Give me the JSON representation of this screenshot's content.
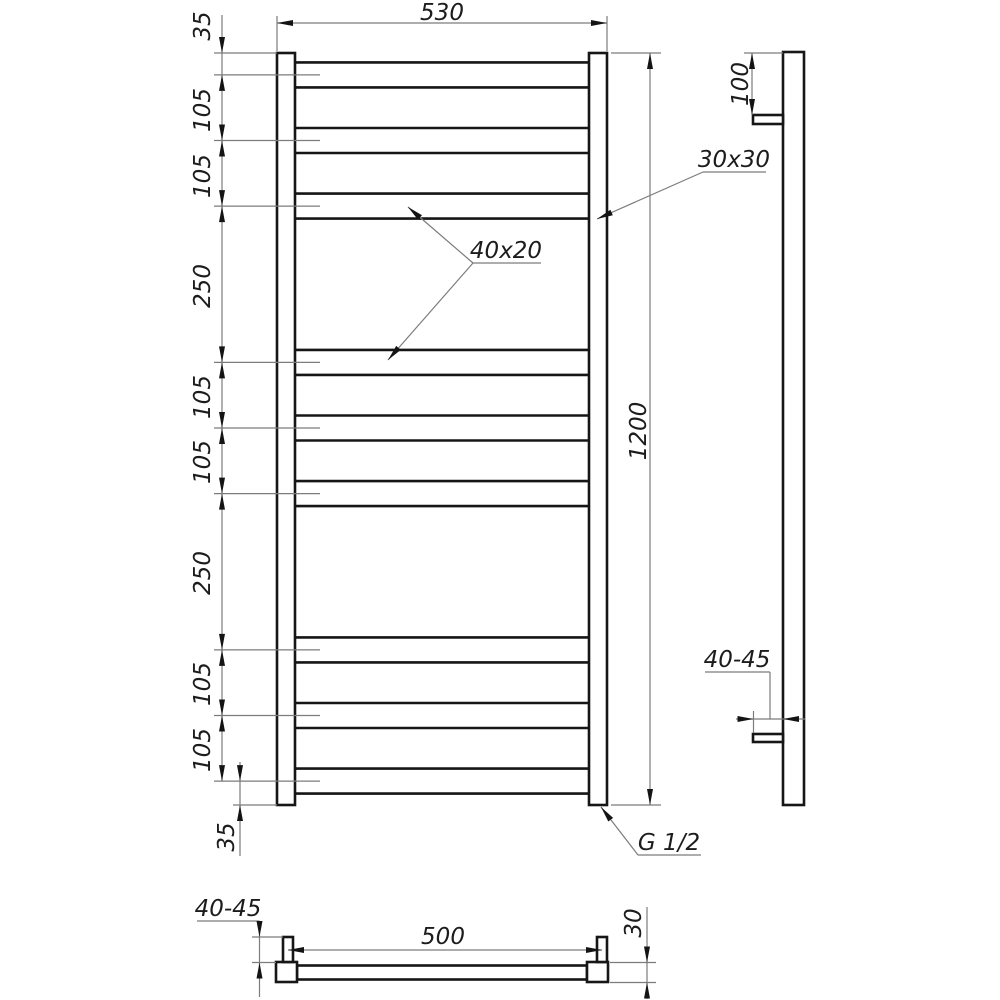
{
  "front": {
    "width_label": "530",
    "height_label": "1200",
    "top_gap_label": "35",
    "bottom_gap_label": "35",
    "rung_profile_label": "40x20",
    "post_profile_label": "30x30",
    "thread_label": "G 1/2"
  },
  "chain": [
    "105",
    "105",
    "250",
    "105",
    "105",
    "250",
    "105",
    "105"
  ],
  "side": {
    "bracket_offset_label": "100",
    "wall_distance_label": "40-45"
  },
  "bottom": {
    "connection_spacing_label": "500",
    "wall_distance_label": "40-45",
    "depth_label": "30"
  }
}
